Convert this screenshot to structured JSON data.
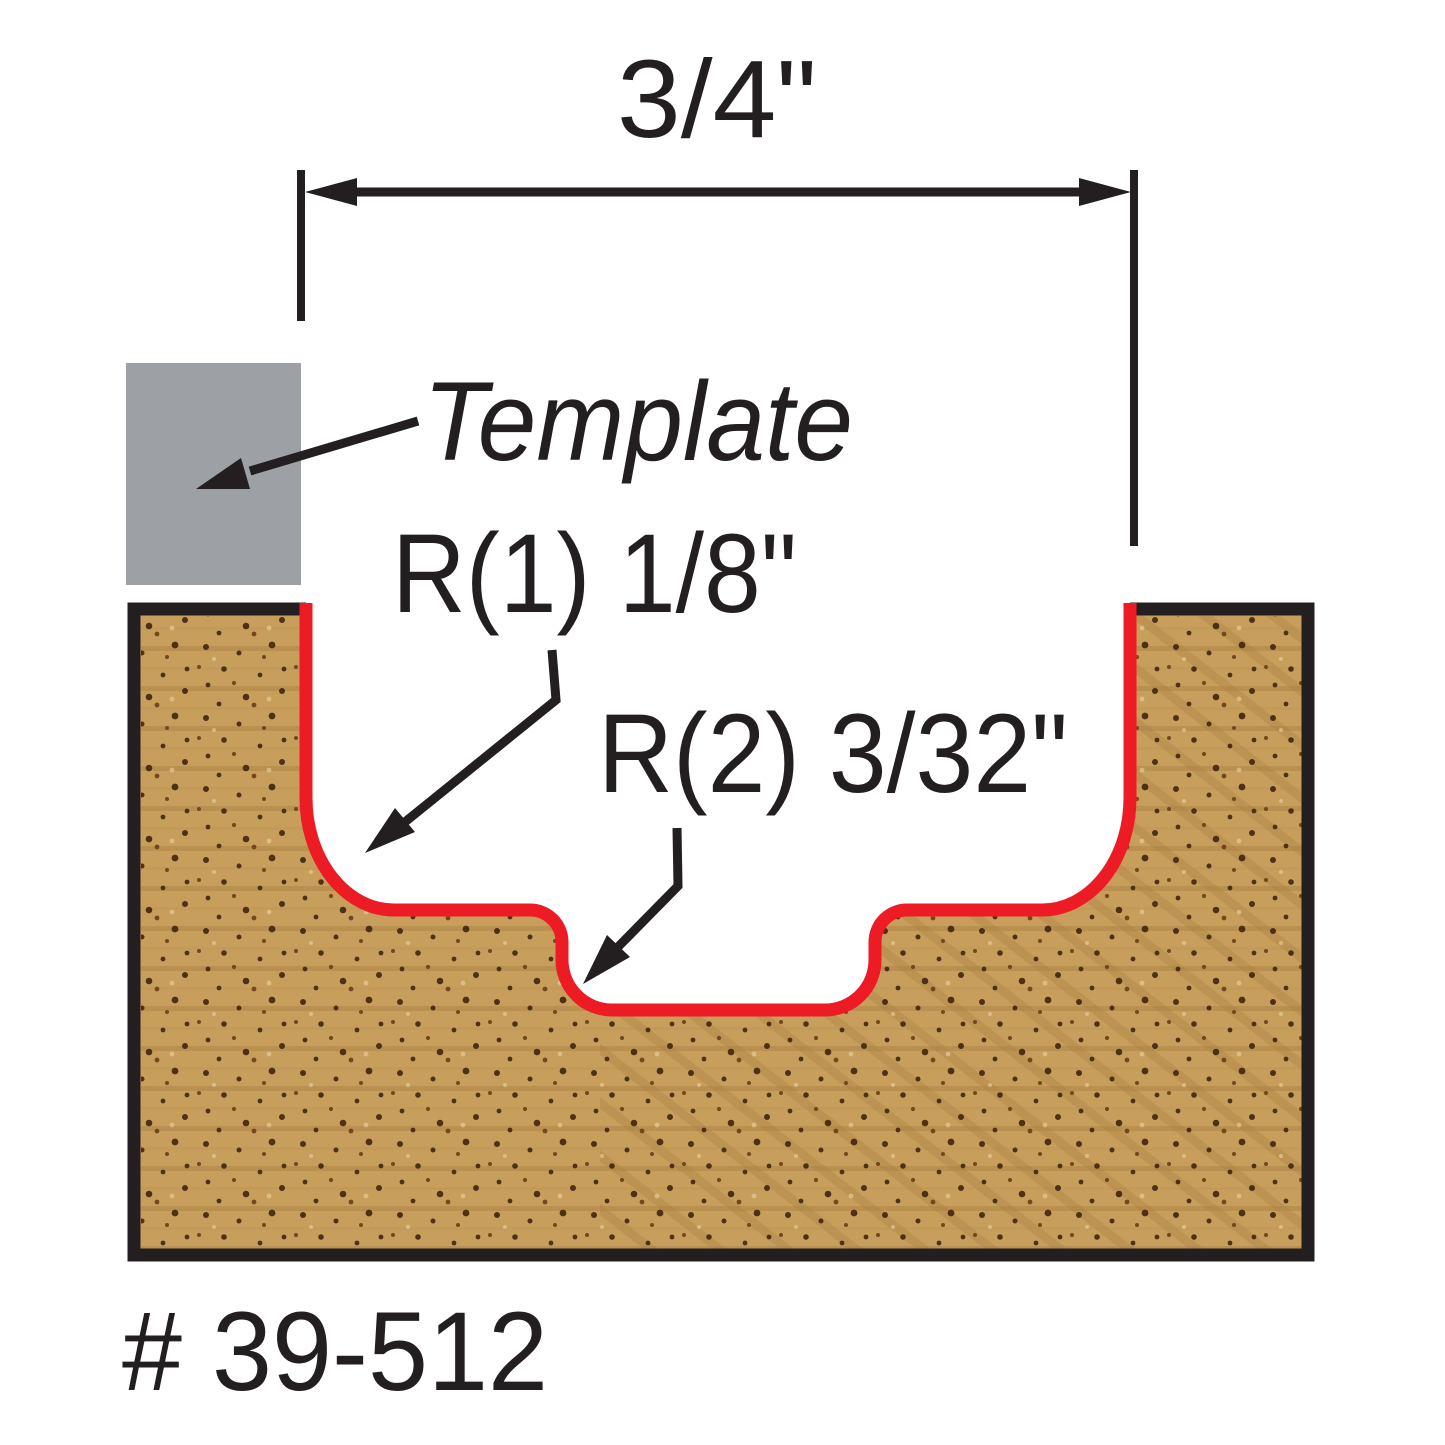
{
  "labels": {
    "dimension": "3/4\"",
    "template": "Template",
    "radius1": "R(1) 1/8\"",
    "radius2": "R(2) 3/32\"",
    "part_number": "# 39-512"
  },
  "colors": {
    "background": "#ffffff",
    "line_black": "#231f20",
    "profile_red": "#ec1b24",
    "template_gray": "#9da0a4",
    "wood_base": "#c89e5c",
    "wood_grain_dark": "#a87f41",
    "wood_grain_light": "#b9925a",
    "wood_speckle": "#3f250d",
    "wood_pore_light": "#ecd9a8"
  }
}
